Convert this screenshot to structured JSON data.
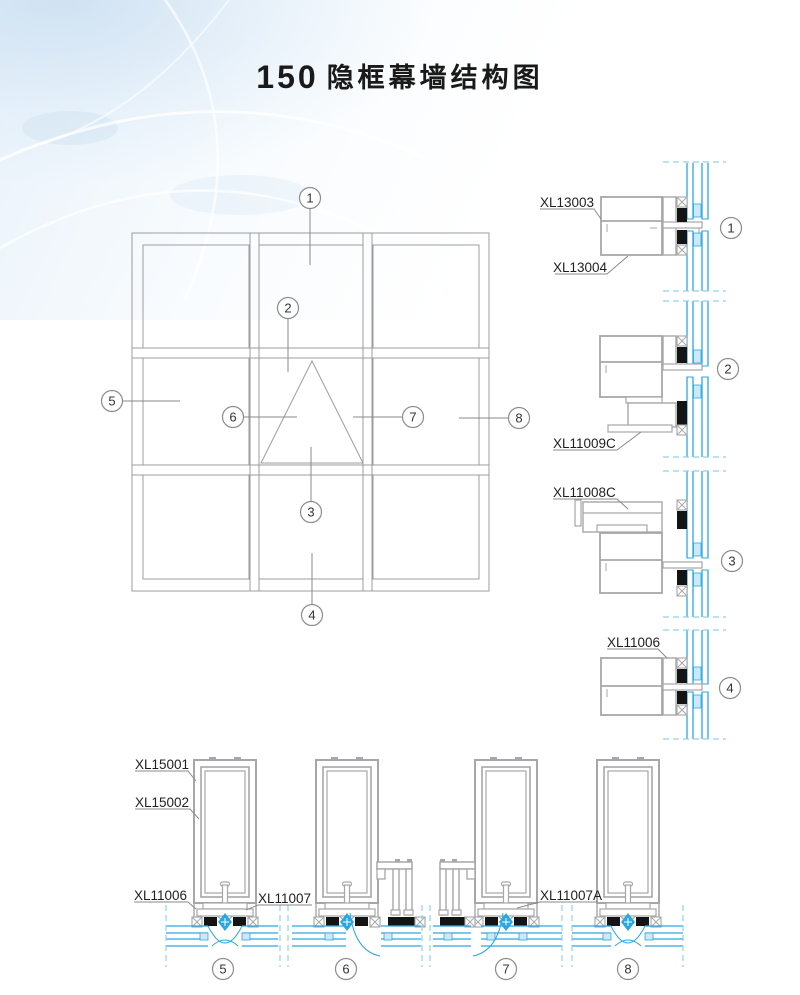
{
  "title": {
    "number": "150",
    "text": "隐框幕墙结构图"
  },
  "callouts": {
    "c1": "1",
    "c2": "2",
    "c3": "3",
    "c4": "4",
    "c5": "5",
    "c6": "6",
    "c7": "7",
    "c8": "8"
  },
  "part_labels": {
    "xl13003": "XL13003",
    "xl13004": "XL13004",
    "xl11009c": "XL11009C",
    "xl11008c": "XL11008C",
    "xl11006": "XL11006",
    "xl15001": "XL15001",
    "xl15002": "XL15002",
    "xl11007": "XL11007",
    "xl11007a": "XL11007A"
  },
  "colors": {
    "glass_blue": "#2BA7E0",
    "glass_blue_light": "#8FD0EF",
    "spacer_fill": "#CBE9F8",
    "profile_gray": "#A7A7A9",
    "line_gray": "#9C9C9C",
    "gasket_black": "#141414",
    "title_black": "#1A1A1A"
  }
}
